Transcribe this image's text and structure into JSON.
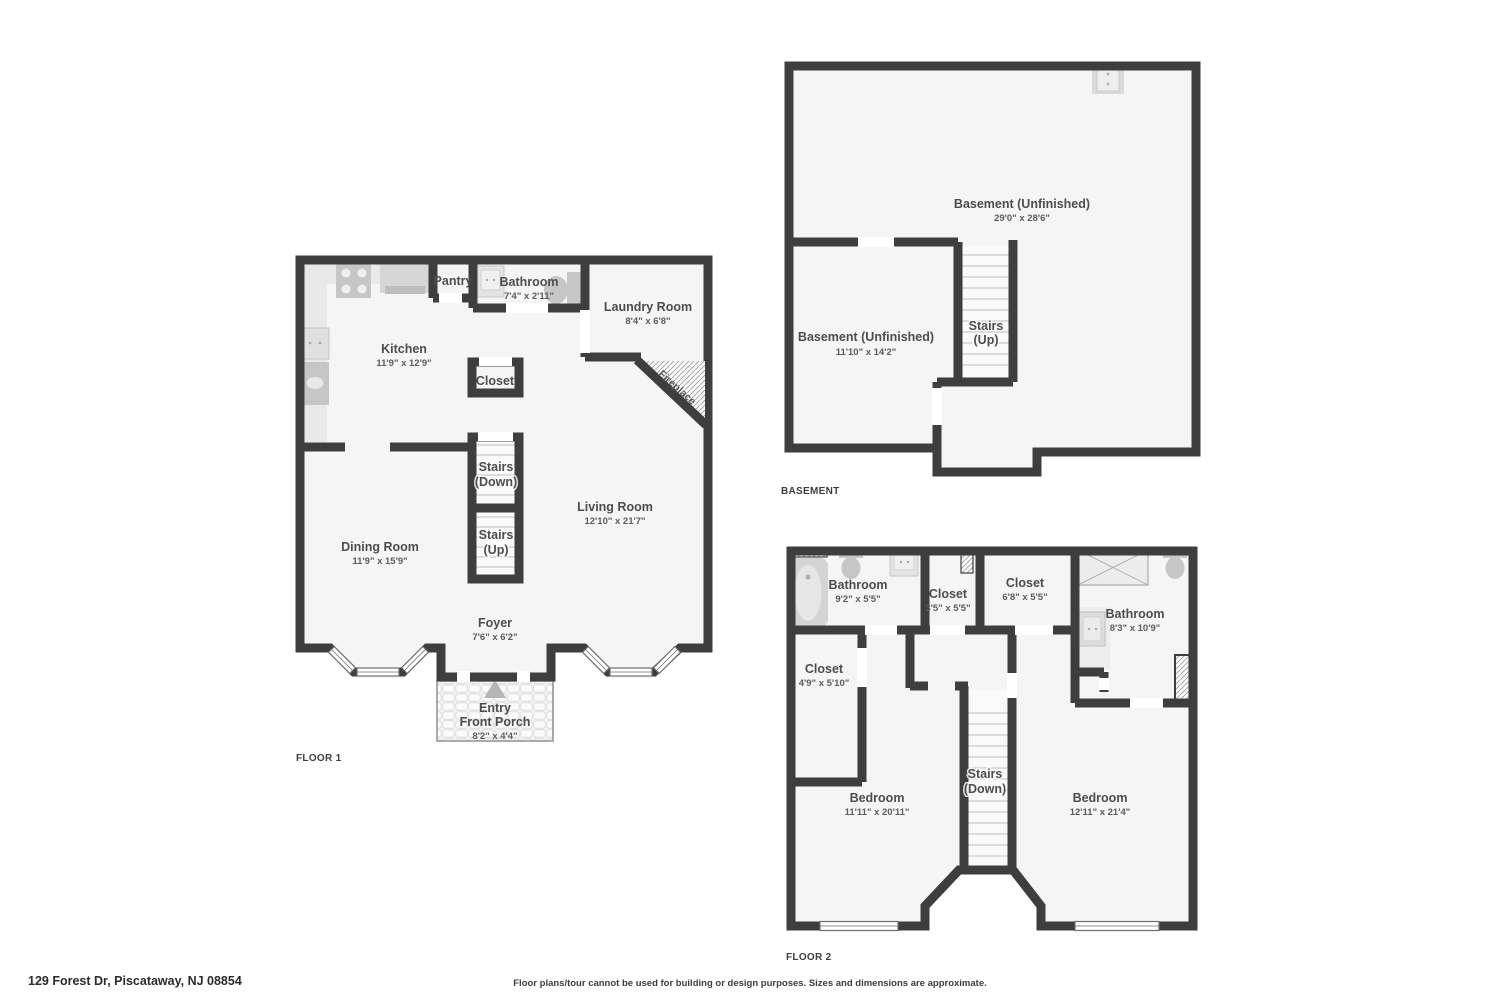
{
  "page": {
    "address": "129 Forest Dr, Piscataway, NJ 08854",
    "disclaimer": "Floor plans/tour cannot be used for building or design purposes. Sizes and dimensions are approximate."
  },
  "colors": {
    "wall": "#3e3e3e",
    "floor": "#f5f5f5",
    "fixture": "#d6d6d6",
    "label": "#4d4d4d"
  },
  "floor1": {
    "tag": "FLOOR 1",
    "kitchen_label": "Kitchen",
    "kitchen_dims": "11'9\" x 12'9\"",
    "pantry_label": "Pantry",
    "bathroom_label": "Bathroom",
    "bathroom_dims": "7'4\" x 2'11\"",
    "laundry_label": "Laundry Room",
    "laundry_dims": "8'4\" x 6'8\"",
    "closet_label": "Closet",
    "stairs_down_label": "Stairs",
    "stairs_down_sub": "(Down)",
    "stairs_up_label": "Stairs",
    "stairs_up_sub": "(Up)",
    "dining_label": "Dining Room",
    "dining_dims": "11'9\" x 15'9\"",
    "living_label": "Living Room",
    "living_dims": "12'10\" x 21'7\"",
    "foyer_label": "Foyer",
    "foyer_dims": "7'6\" x 6'2\"",
    "entry_label": "Entry",
    "entry_sub": "Front Porch",
    "entry_dims": "8'2\" x 4'4\"",
    "fireplace_label": "Fireplace"
  },
  "basement": {
    "tag": "BASEMENT",
    "main_label": "Basement (Unfinished)",
    "main_dims": "29'0\" x 28'6\"",
    "second_label": "Basement (Unfinished)",
    "second_dims": "11'10\" x 14'2\"",
    "stairs_label": "Stairs",
    "stairs_sub": "(Up)"
  },
  "floor2": {
    "tag": "FLOOR 2",
    "bath_left_label": "Bathroom",
    "bath_left_dims": "9'2\" x 5'5\"",
    "closet_small_label": "Closet",
    "closet_small_dims": "3'5\" x 5'5\"",
    "closet_mid_label": "Closet",
    "closet_mid_dims": "6'8\" x 5'5\"",
    "bath_right_label": "Bathroom",
    "bath_right_dims": "8'3\" x 10'9\"",
    "closet_left_label": "Closet",
    "closet_left_dims": "4'9\" x 5'10\"",
    "bedroom_left_label": "Bedroom",
    "bedroom_left_dims": "11'11\" x 20'11\"",
    "bedroom_right_label": "Bedroom",
    "bedroom_right_dims": "12'11\" x 21'4\"",
    "stairs_label": "Stairs",
    "stairs_sub": "(Down)"
  }
}
